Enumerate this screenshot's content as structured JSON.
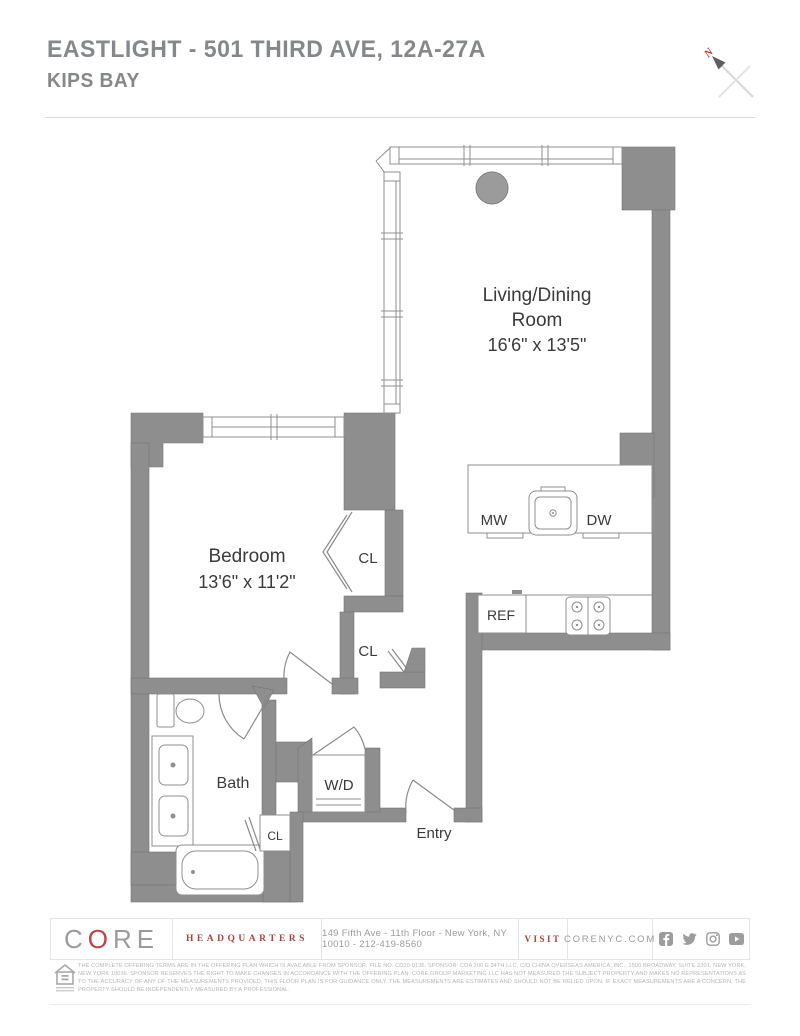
{
  "header": {
    "title": "EASTLIGHT - 501 THIRD AVE, 12A-27A",
    "subtitle": "KIPS BAY",
    "compass_letter": "N"
  },
  "plan": {
    "rooms": {
      "living_dining": {
        "name_line1": "Living/Dining",
        "name_line2": "Room",
        "dims": "16'6\" x 13'5\""
      },
      "bedroom": {
        "name": "Bedroom",
        "dims": "13'6\" x 11'2\""
      },
      "bath": {
        "name": "Bath"
      },
      "entry": {
        "name": "Entry"
      },
      "closet1": {
        "name": "CL"
      },
      "closet2": {
        "name": "CL"
      },
      "closet3": {
        "name": "CL"
      },
      "washer_dryer": {
        "name": "W/D"
      }
    },
    "appliances": {
      "microwave": "MW",
      "dishwasher": "DW",
      "refrigerator": "REF"
    }
  },
  "footer": {
    "brand_c": "C",
    "brand_o": "O",
    "brand_re": "RE",
    "headquarters_label": "HEADQUARTERS",
    "address": "149 Fifth Ave - 11th Floor - New York, NY 10010 - 212-419-8560",
    "visit_label": "VISIT",
    "website": "CORENYC.COM",
    "social_icons": [
      "facebook-icon",
      "twitter-icon",
      "instagram-icon",
      "youtube-icon"
    ],
    "disclaimer": "THE COMPLETE OFFERING TERMS ARE IN THE OFFERING PLAN WHICH IS AVAILABLE FROM SPONSOR. FILE NO. CD20-0136. SPONSOR: COA 200 E 34TH LLC, C/O CHINA OVERSEAS AMERICA, INC., 1500 BROADWAY, SUITE 2301, NEW YORK, NEW YORK 10036. SPONSOR RESERVES THE RIGHT TO MAKE CHANGES IN ACCORDANCE WITH THE OFFERING PLAN. CORE GROUP MARKETING LLC HAS NOT MEASURED THE SUBJECT PROPERTY AND MAKES NO REPRESENTATIONS AS TO THE ACCURACY OF ANY OF THE MEASUREMENTS PROVIDED. THIS FLOOR PLAN IS FOR GUIDANCE ONLY. THE MEASUREMENTS ARE ESTIMATES AND SHOULD NOT BE RELIED UPON. IF EXACT MEASUREMENTS ARE A CONCERN, THE PROPERTY SHOULD BE INDEPENDENTLY MEASURED BY A PROFESSIONAL."
  },
  "colors": {
    "wall_gray": "#8e8e8e",
    "accent_red": "#b0413d",
    "title_gray": "#85878a"
  }
}
